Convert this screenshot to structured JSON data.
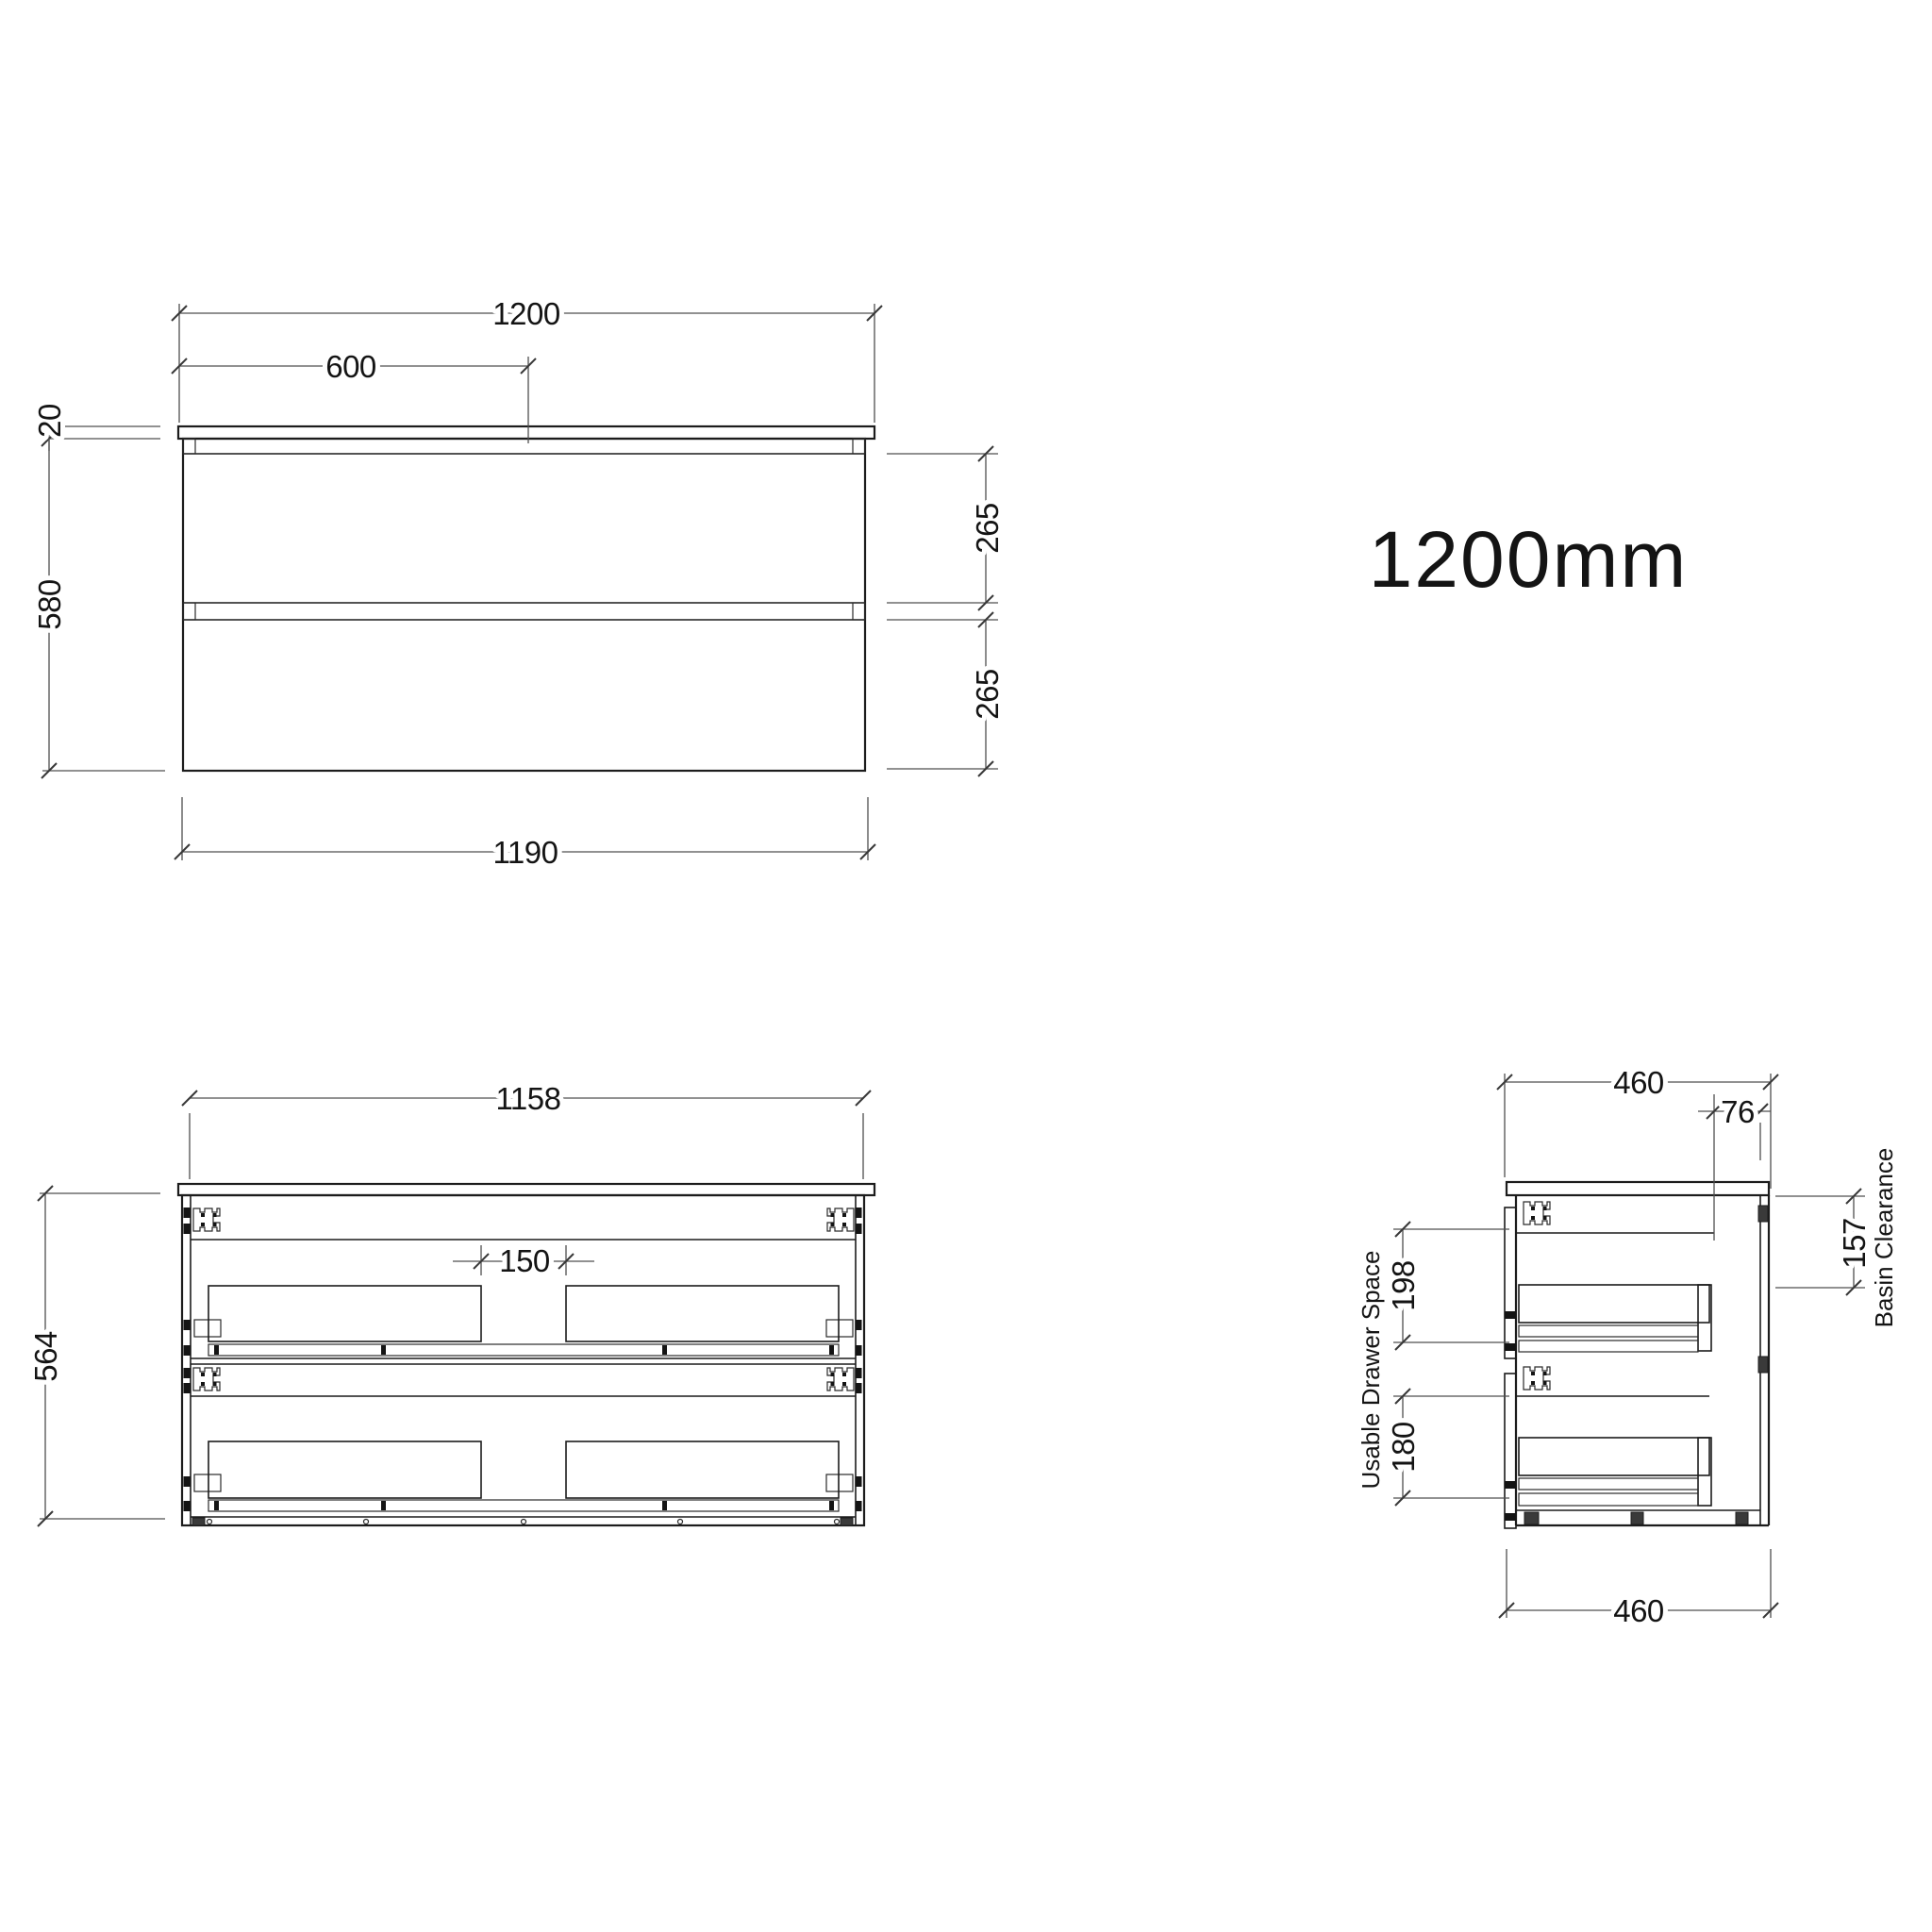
{
  "title": {
    "label": "1200mm"
  },
  "colors": {
    "background": "#ffffff",
    "object_line": "#1c1c1c",
    "dimension_line": "#4f4f4f",
    "text": "#141414"
  },
  "front_view": {
    "name": "front elevation",
    "dims": {
      "total_width": "1200",
      "half_width": "600",
      "counter_thickness": "20",
      "cabinet_height": "580",
      "top_drawer_height": "265",
      "bottom_drawer_height": "265",
      "body_width": "1190"
    }
  },
  "open_view": {
    "name": "front internal elevation",
    "dims": {
      "internal_width": "1158",
      "internal_height": "564",
      "basin_gap": "150"
    }
  },
  "side_view": {
    "name": "side section",
    "dims": {
      "depth_top": "460",
      "back_offset": "76",
      "basin_clearance": "157",
      "top_drawer_space": "198",
      "bottom_drawer_space": "180",
      "depth_bottom": "460"
    },
    "labels": {
      "basin_clearance": "Basin Clearance",
      "usable_drawer_space": "Usable Drawer Space"
    }
  }
}
